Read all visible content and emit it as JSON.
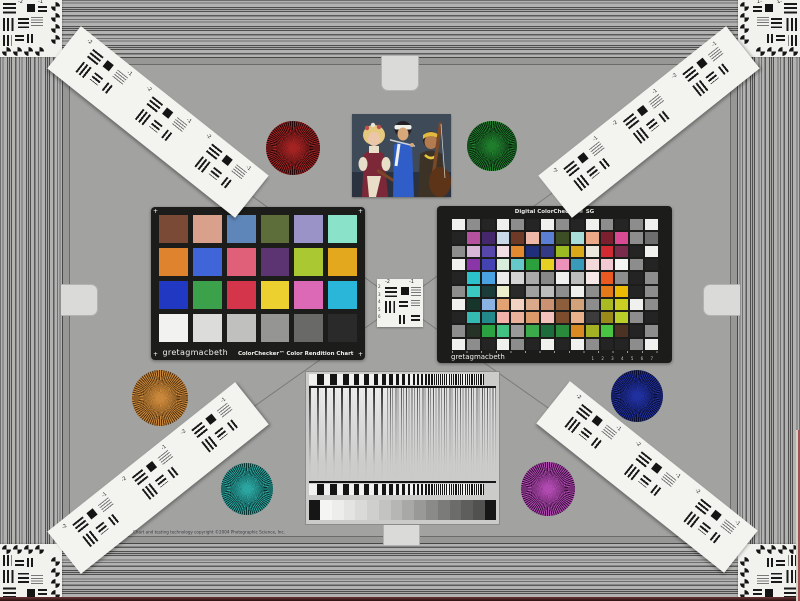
{
  "scene": {
    "name": "camera test chart"
  },
  "colorchecker": {
    "brand": "gretagmacbeth",
    "title": "ColorChecker™ Color Rendition Chart",
    "rows": [
      [
        "#7b4a36",
        "#d9a08c",
        "#5f86b8",
        "#5d6e3a",
        "#9a93c8",
        "#8ae3c9"
      ],
      [
        "#e0832f",
        "#3f65d9",
        "#e0607a",
        "#5c3472",
        "#aac832",
        "#e3a81e"
      ],
      [
        "#2038c2",
        "#3ba24b",
        "#d4354a",
        "#ecd02f",
        "#dc69b6",
        "#29b6d8"
      ],
      [
        "#f2f2f0",
        "#dcdcda",
        "#c0c0bf",
        "#959594",
        "#696968",
        "#2a2a2a"
      ]
    ]
  },
  "sg": {
    "title": "Digital ColorChecker® SG",
    "brand": "gretagmacbeth",
    "ruler": "1 2 3 4 5 6 7",
    "rows": [
      [
        "#f0f0ee",
        "#8d8d8d",
        "#252525",
        "#f0f0ee",
        "#8d8d8d",
        "#252525",
        "#f0f0ee",
        "#8d8d8d",
        "#252525",
        "#f0f0ee",
        "#8d8d8d",
        "#252525",
        "#8d8d8d",
        "#f0f0ee"
      ],
      [
        "#242424",
        "#b5529f",
        "#45276b",
        "#c9d9ea",
        "#6e3a28",
        "#edb8a8",
        "#5b7fd2",
        "#3c4e26",
        "#a8ddd8",
        "#eba988",
        "#7c2030",
        "#d84a92",
        "#8d8d8d",
        "#6e6e6e"
      ],
      [
        "#8d8d8d",
        "#d9b7d9",
        "#5747ab",
        "#f2dde4",
        "#e28a32",
        "#1f2f7c",
        "#343b84",
        "#9cbb22",
        "#d9a91a",
        "#ece7dc",
        "#d22a32",
        "#7a2a4a",
        "#242424",
        "#f0f0ee"
      ],
      [
        "#f0f0ee",
        "#8a35a8",
        "#4543b2",
        "#d9eddc",
        "#66c8c8",
        "#2ba03c",
        "#e6d024",
        "#ec92ba",
        "#3a9aba",
        "#f2dada",
        "#f2cad2",
        "#f4f4f2",
        "#8d8d8d",
        "#242424"
      ],
      [
        "#242424",
        "#2cc2cc",
        "#4aa2e2",
        "#eaeaea",
        "#d4d4d4",
        "#aaaaaa",
        "#888888",
        "#f0f0ee",
        "#bdbdbd",
        "#f6e8e8",
        "#e85a22",
        "#8d8d8d",
        "#242424",
        "#8d8d8d"
      ],
      [
        "#8d8d8d",
        "#3cc8c2",
        "#1c3c3a",
        "#ecedcd",
        "#2a2a2a",
        "#a0a0a0",
        "#bdbdbd",
        "#8d8d8d",
        "#f0f0ee",
        "#8d8d8d",
        "#e27a1a",
        "#ecba02",
        "#242424",
        "#8d8d8d"
      ],
      [
        "#f0f0ee",
        "#16362c",
        "#8ab2e2",
        "#e2a272",
        "#f2d2c2",
        "#daaa8a",
        "#ca9272",
        "#8c5e3c",
        "#d2a27a",
        "#8d8d8d",
        "#aaba22",
        "#cace22",
        "#f0f0ee",
        "#8d8d8d"
      ],
      [
        "#242424",
        "#34bab2",
        "#228a8a",
        "#f2b2aa",
        "#eab29a",
        "#da9a6a",
        "#f2c2ba",
        "#7c4c2c",
        "#eab28a",
        "#3c3c3c",
        "#9a8a1a",
        "#bace2a",
        "#8d8d8d",
        "#242424"
      ],
      [
        "#8d8d8d",
        "#263226",
        "#2aa242",
        "#42c282",
        "#9a9a9a",
        "#3aaa4a",
        "#1c6c3c",
        "#2a8a3c",
        "#da8a22",
        "#a2b222",
        "#4ac242",
        "#4c3222",
        "#242424",
        "#8d8d8d"
      ],
      [
        "#f0f0ee",
        "#8d8d8d",
        "#242424",
        "#f0f0ee",
        "#8d8d8d",
        "#242424",
        "#f0f0ee",
        "#242424",
        "#f0f0ee",
        "#8d8d8d",
        "#242424",
        "#242424",
        "#8d8d8d",
        "#f0f0ee"
      ]
    ]
  },
  "stars": [
    {
      "name": "red",
      "color": "#a32222",
      "dark": "#260808"
    },
    {
      "name": "green",
      "color": "#1f7d2c",
      "dark": "#071f0c"
    },
    {
      "name": "orange",
      "color": "#c8873a",
      "dark": "#553511"
    },
    {
      "name": "blue",
      "color": "#20309f",
      "dark": "#080c2e"
    },
    {
      "name": "teal",
      "color": "#2ba5a0",
      "dark": "#093331"
    },
    {
      "name": "magenta",
      "color": "#b04ab0",
      "dark": "#380f3a"
    }
  ],
  "usaf": {
    "labels": [
      "-2",
      "-1"
    ],
    "side_numbers": [
      "2",
      "3",
      "4",
      "5",
      "6"
    ]
  },
  "gradient_panel": {
    "sweep": {
      "count": 90,
      "start": 7.5,
      "ratio": 0.95
    },
    "wedge_steps": [
      "#f5f5f4",
      "#ededec",
      "#e4e4e3",
      "#dadad9",
      "#cfcfce",
      "#c3c3c2",
      "#b6b6b5",
      "#a8a8a7",
      "#999998",
      "#8a8a89",
      "#7b7b7a",
      "#6c6c6b",
      "#5e5e5d",
      "#515150"
    ]
  },
  "photo": {
    "palette": {
      "bg": "#3e4a58",
      "floor": "#2a3240",
      "hair_left": "#e5c97e",
      "flower": "#c05050",
      "flower2": "#e8e4da",
      "skin_left": "#ecc6a8",
      "dress": "#7d2838",
      "blouse": "#e9dfc8",
      "hair_mid": "#241f24",
      "band": "#f0f0ea",
      "skin_mid": "#d8a87a",
      "tunic": "#2f5ec8",
      "flute": "#ccd2d8",
      "hair_right": "#2c2018",
      "skin_right": "#b27c50",
      "headband": "#e2b93e",
      "vest": "#3c3226",
      "necklace": "#e6c63c",
      "wood": "#7a4826",
      "wood_dark": "#5e3418"
    }
  },
  "footer": {
    "copyright": "Chart and testing technology copyright ©2004 Photographic Science, Inc."
  }
}
